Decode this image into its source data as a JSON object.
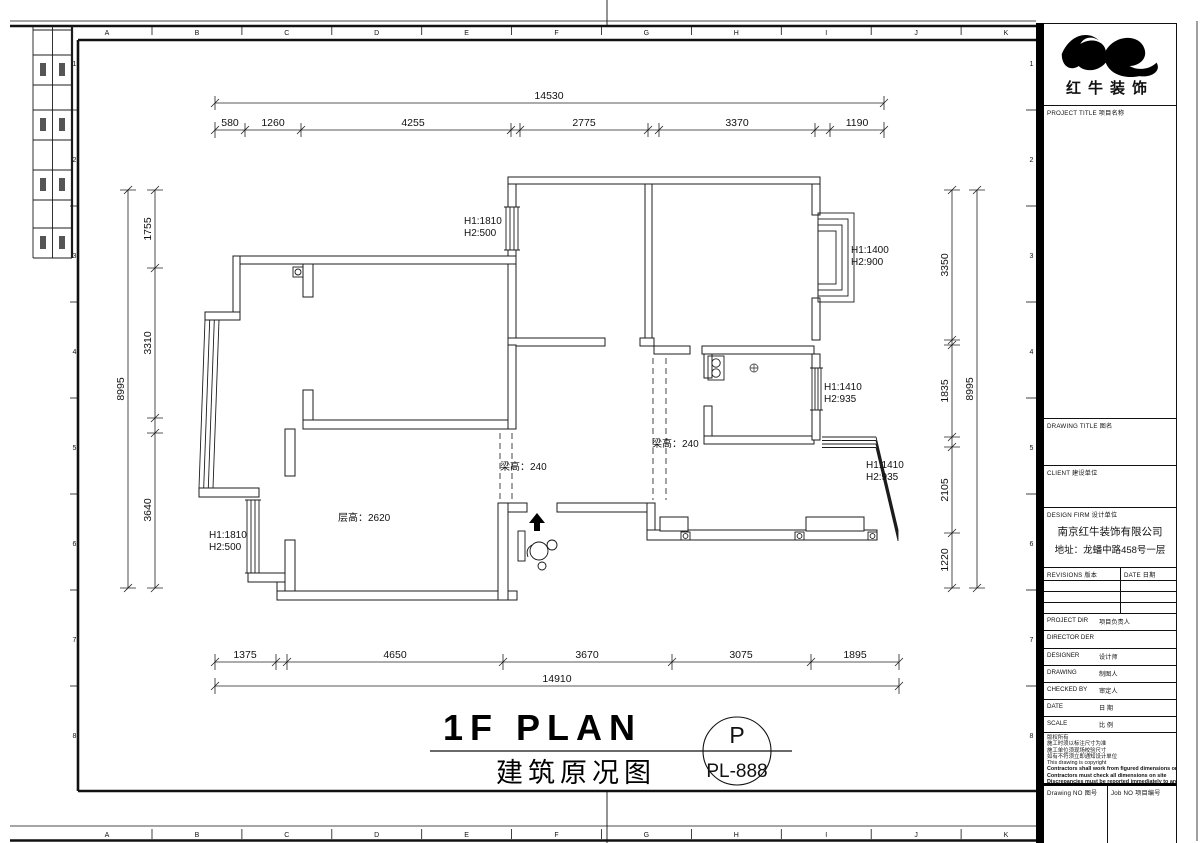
{
  "frame": {
    "letters": [
      "A",
      "B",
      "C",
      "D",
      "E",
      "F",
      "G",
      "H",
      "I",
      "J",
      "K"
    ],
    "numbers": [
      "1",
      "2",
      "3",
      "4",
      "5",
      "6",
      "7",
      "8"
    ]
  },
  "plan": {
    "title": {
      "en": "1F PLAN",
      "cn": "建筑原况图",
      "stamp_letter": "P",
      "stamp_code": "PL-888"
    },
    "dims": {
      "top_overall": "14530",
      "top_segments": [
        "580",
        "1260",
        "4255",
        "2775",
        "3370",
        "1190"
      ],
      "bottom_segments": [
        "1375",
        "4650",
        "3670",
        "3075",
        "1895"
      ],
      "bottom_overall": "14910",
      "left_overall": "8995",
      "left_segments": [
        "1755",
        "3310",
        "3640"
      ],
      "right_segments": [
        "3350",
        "1835",
        "2105",
        "1220"
      ],
      "right_overall": "8995"
    },
    "annotations": {
      "window_top_left": {
        "h1": "H1:1810",
        "h2": "H2:500"
      },
      "window_bottom_left": {
        "h1": "H1:1810",
        "h2": "H2:500"
      },
      "window_top_right": {
        "h1": "H1:1400",
        "h2": "H2:900"
      },
      "window_kitchen": {
        "h1": "H1:1410",
        "h2": "H2:935"
      },
      "window_bay_right": {
        "h1": "H1:1410",
        "h2": "H2:935"
      },
      "floor_height": "层高：2620",
      "beam_height_left": "梁高：240",
      "beam_height_right": "梁高：240"
    }
  },
  "titleblock": {
    "logo_name": "红牛装饰",
    "project_title": "PROJECT TITLE  项目名称",
    "drawing_title": "DRAWING TITLE  图名",
    "client": "CLIENT  建设单位",
    "design_firm": "DESIGN FIRM  设计单位",
    "firm_name": "南京红牛装饰有限公司",
    "firm_addr": "地址：龙蟠中路458号一层",
    "revisions": "REVISIONS 版本",
    "date_col": "DATE 日期",
    "rows": [
      {
        "label": "PROJECT DIR",
        "cn": "项目负责人"
      },
      {
        "label": "DIRECTOR DER",
        "cn": ""
      },
      {
        "label": "DESIGNER",
        "cn": "设计师"
      },
      {
        "label": "DRAWING",
        "cn": "制图人"
      },
      {
        "label": "CHECKED BY",
        "cn": "审定人"
      },
      {
        "label": "DATE",
        "cn": "日 期"
      },
      {
        "label": "SCALE",
        "cn": "比 例"
      }
    ],
    "copyright": [
      "版权所有",
      "施工时须以标注尺寸为准",
      "施工单位须现场校验尺寸",
      "如有不符须立即通知设计单位",
      "This drawing is copyright",
      "Contractors shall work from figured dimensions only",
      "Contractors must check all dimensions on site",
      "Discrepancies must be reported immediately to architects"
    ],
    "drawing_no": "Drawing NO 图号",
    "job_no": "Job NO 项目编号"
  }
}
